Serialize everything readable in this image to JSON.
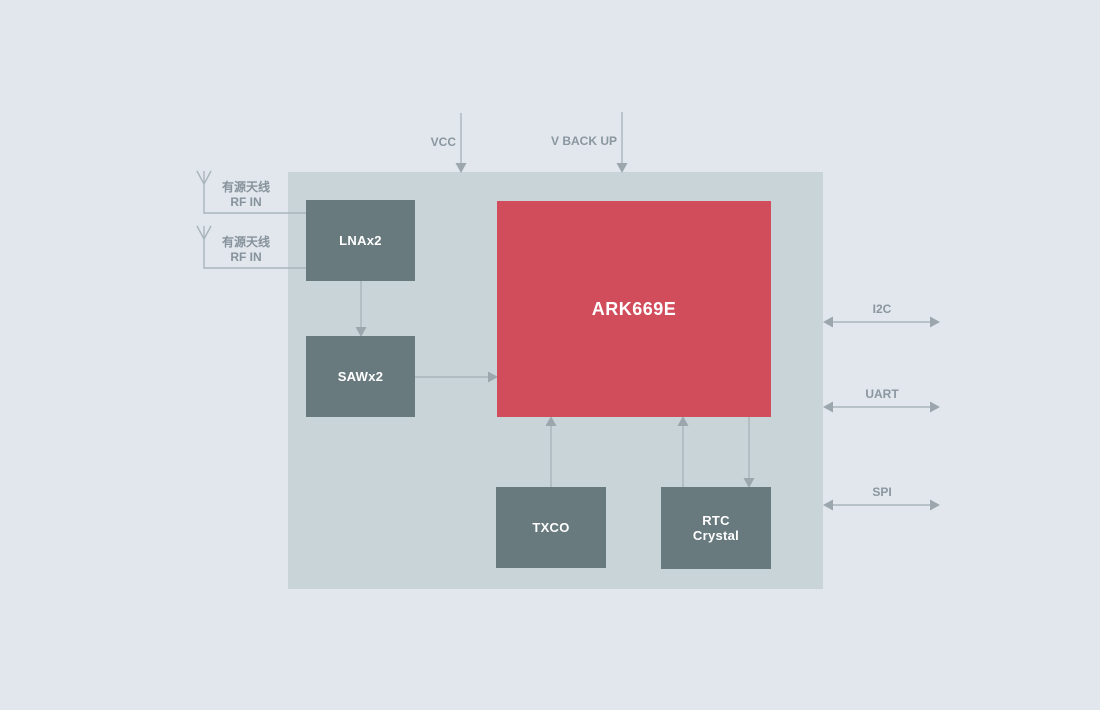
{
  "diagram": {
    "chip": {
      "label": "ARK669E",
      "color": "#d24d5b"
    },
    "blocks": {
      "lna": {
        "label": "LNAx2"
      },
      "saw": {
        "label": "SAWx2"
      },
      "txco": {
        "label": "TXCO"
      },
      "rtc": {
        "line1": "RTC",
        "line2": "Crystal"
      }
    },
    "antennas": [
      {
        "name": "有源天线",
        "port": "RF IN"
      },
      {
        "name": "有源天线",
        "port": "RF IN"
      }
    ],
    "power_inputs": [
      {
        "label": "VCC"
      },
      {
        "label": "V BACK UP"
      }
    ],
    "interfaces": [
      {
        "label": "I2C"
      },
      {
        "label": "UART"
      },
      {
        "label": "SPI"
      }
    ],
    "colors": {
      "background": "#e1e7ec",
      "board": "#c9d4d9",
      "block": "#697a7e",
      "chip_accent": "#d24d5b",
      "wire": "#a9b5bb",
      "arrowhead": "#9ba7ad",
      "label_text": "#8a96a0"
    }
  }
}
